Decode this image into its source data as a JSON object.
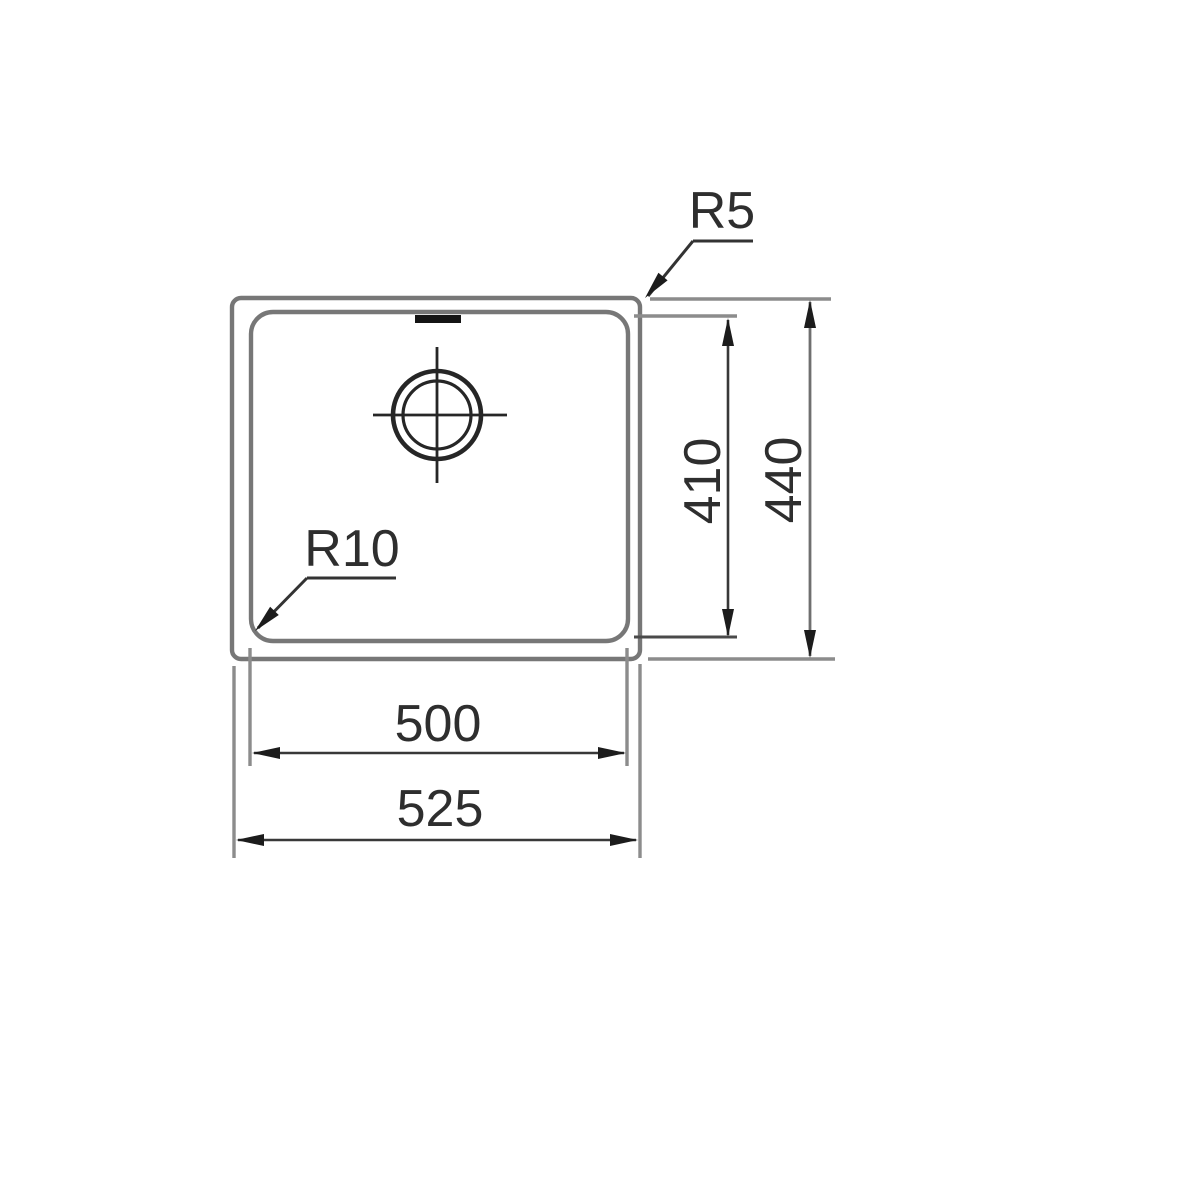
{
  "drawing": {
    "kind": "technical-dimension-drawing",
    "subject": "sink bowl top view with dimensions",
    "labels": {
      "outer_corner_radius": "R5",
      "inner_corner_radius": "R10",
      "inner_height": "410",
      "outer_height": "440",
      "inner_width": "500",
      "outer_width": "525"
    },
    "colors": {
      "background": "#ffffff",
      "outline_gray": "#777777",
      "extension_gray": "#8c8c8c",
      "dimension_dark": "#383838",
      "text": "#2e2e2e",
      "drain_black": "#262626"
    }
  }
}
